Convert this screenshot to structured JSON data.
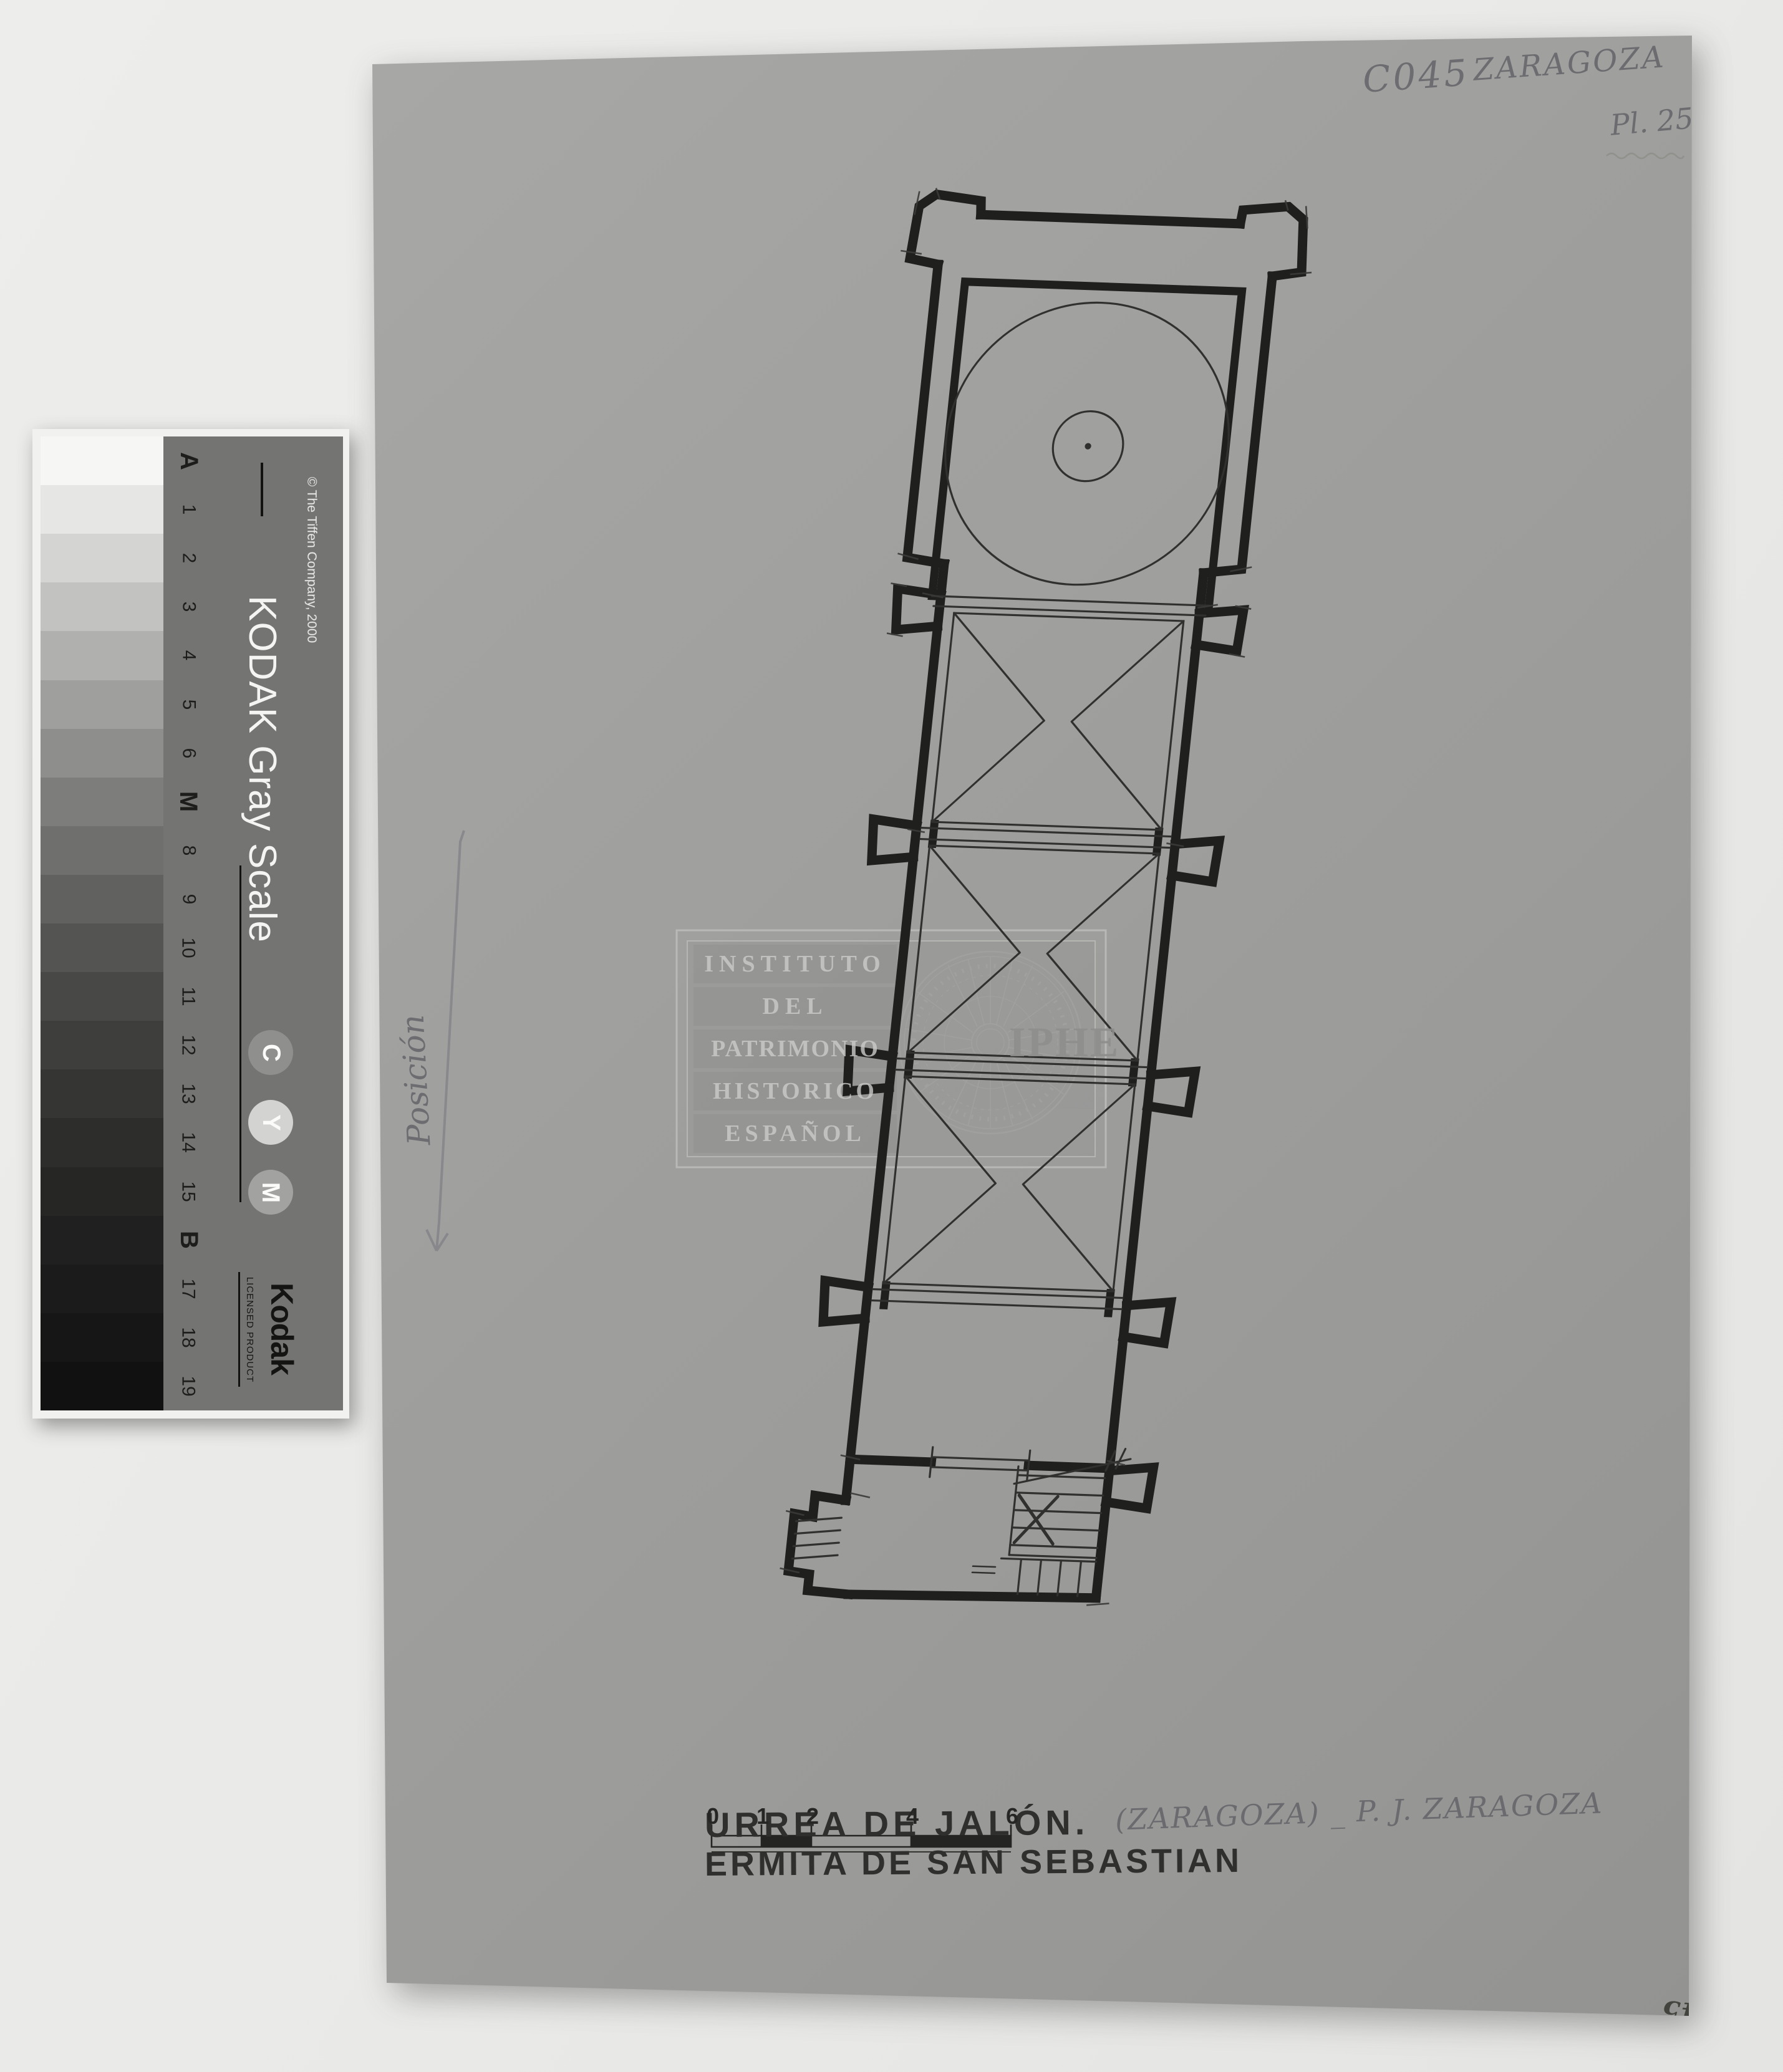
{
  "document": {
    "archive_code": "C045",
    "archive_region": "Zaragoza",
    "plate_number": "Pl. 25",
    "corner_number": "45",
    "orientation_note": "Posición",
    "title_line1": "URREA DE JALÓN.",
    "title_line1_annotation": "(Zaragoza) _ P. J. Zaragoza",
    "title_line2": "ERMITA DE SAN SEBASTIAN"
  },
  "scale_bar": {
    "labels": [
      "0",
      "1",
      "2",
      "4",
      "6"
    ]
  },
  "watermark": {
    "lines": [
      "INSTITUTO",
      "DEL",
      "PATRIMONIO",
      "HISTORICO",
      "ESPAÑOL"
    ],
    "logo": "IPHE"
  },
  "kodak": {
    "title": "KODAK Gray Scale",
    "copyright": "© The Tiffen Company, 2000",
    "brand": "Kodak",
    "licensed": "LICENSED PRODUCT",
    "cym": [
      {
        "letter": "C",
        "color": "#8f8f8d"
      },
      {
        "letter": "Y",
        "color": "#d3d3d1"
      },
      {
        "letter": "M",
        "color": "#a2a2a0"
      }
    ],
    "steps": [
      {
        "label": "A",
        "color": "#f6f6f4",
        "bold": true
      },
      {
        "label": "1",
        "color": "#e6e6e4",
        "bold": false
      },
      {
        "label": "2",
        "color": "#d4d4d2",
        "bold": false
      },
      {
        "label": "3",
        "color": "#c2c2c0",
        "bold": false
      },
      {
        "label": "4",
        "color": "#b0b0ae",
        "bold": false
      },
      {
        "label": "5",
        "color": "#9f9f9d",
        "bold": false
      },
      {
        "label": "6",
        "color": "#8e8e8c",
        "bold": false
      },
      {
        "label": "M",
        "color": "#7d7d7b",
        "bold": true
      },
      {
        "label": "8",
        "color": "#6f6f6d",
        "bold": false
      },
      {
        "label": "9",
        "color": "#616160",
        "bold": false
      },
      {
        "label": "10",
        "color": "#545453",
        "bold": false
      },
      {
        "label": "11",
        "color": "#484847",
        "bold": false
      },
      {
        "label": "12",
        "color": "#3e3e3d",
        "bold": false
      },
      {
        "label": "13",
        "color": "#353534",
        "bold": false
      },
      {
        "label": "14",
        "color": "#2d2d2c",
        "bold": false
      },
      {
        "label": "15",
        "color": "#262625",
        "bold": false
      },
      {
        "label": "B",
        "color": "#202020",
        "bold": true
      },
      {
        "label": "17",
        "color": "#1b1b1b",
        "bold": false
      },
      {
        "label": "18",
        "color": "#161616",
        "bold": false
      },
      {
        "label": "19",
        "color": "#111111",
        "bold": false
      }
    ]
  },
  "colors": {
    "page_background": "#e9e9e7",
    "paper": "#9e9e9c",
    "ink": "#1f1f1d",
    "pencil": "#75757a",
    "card_panel": "#747472"
  }
}
